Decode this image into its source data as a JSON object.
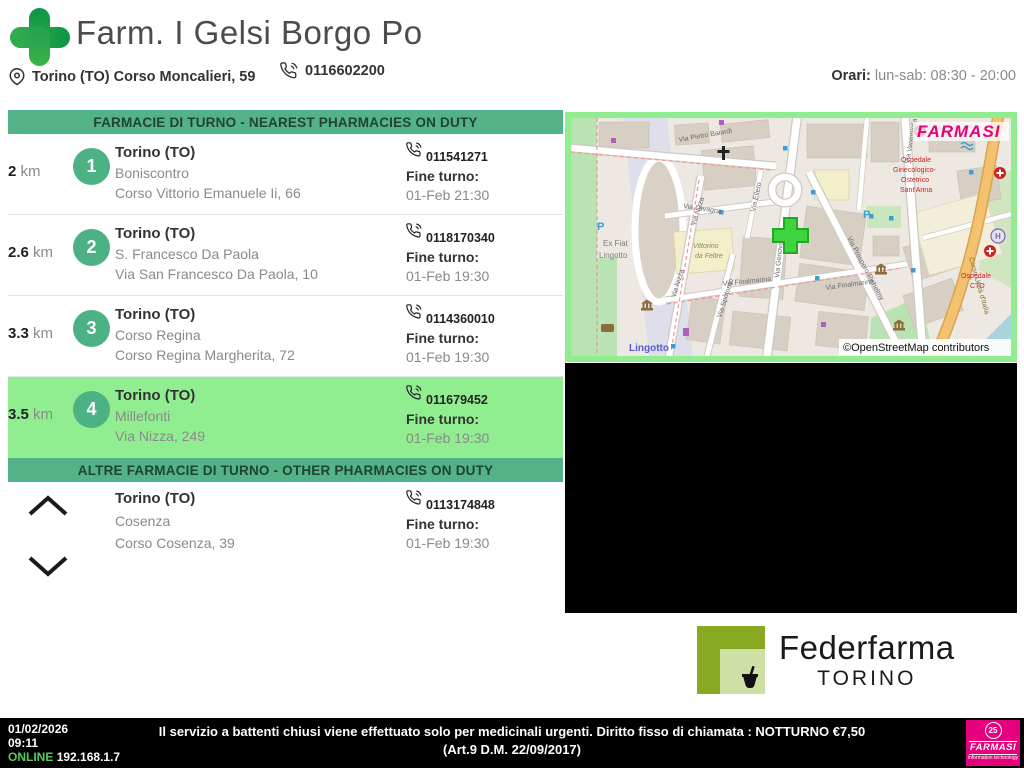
{
  "header": {
    "title": "Farm. I Gelsi Borgo Po",
    "address": "Torino (TO) Corso Moncalieri, 59",
    "phone": "0116602200",
    "orari_label": "Orari:",
    "orari_value": "lun-sab: 08:30 - 20:00"
  },
  "list": {
    "nearest_header": "FARMACIE DI TURNO - NEAREST PHARMACIES ON DUTY",
    "other_header": "ALTRE FARMACIE DI TURNO - OTHER PHARMACIES ON DUTY",
    "km_label": "km",
    "fine_turno_label": "Fine turno:",
    "rows": [
      {
        "distance": "2",
        "number": "1",
        "city": "Torino (TO)",
        "name": "Boniscontro",
        "address": "Corso Vittorio Emanuele Ii, 66",
        "phone": "011541271",
        "end": "01-Feb 21:30"
      },
      {
        "distance": "2.6",
        "number": "2",
        "city": "Torino (TO)",
        "name": "S. Francesco Da Paola",
        "address": "Via San Francesco Da Paola, 10",
        "phone": "0118170340",
        "end": "01-Feb 19:30"
      },
      {
        "distance": "3.3",
        "number": "3",
        "city": "Torino (TO)",
        "name": "Corso Regina",
        "address": "Corso Regina Margherita, 72",
        "phone": "0114360010",
        "end": "01-Feb 19:30"
      },
      {
        "distance": "3.5",
        "number": "4",
        "city": "Torino (TO)",
        "name": "Millefonti",
        "address": "Via Nizza, 249",
        "phone": "011679452",
        "end": "01-Feb 19:30"
      }
    ],
    "other_row": {
      "city": "Torino (TO)",
      "name": "Cosenza",
      "address": "Corso Cosenza, 39",
      "phone": "0113174848",
      "end": "01-Feb 19:30"
    }
  },
  "map": {
    "provider_logo": "FARMASI",
    "attribution": "©OpenStreetMap contributors",
    "labels": [
      {
        "t": "Via Pietro Baiardi",
        "x": 108,
        "y": 24,
        "s": 7,
        "c": "#6b6b6b",
        "r": -10
      },
      {
        "t": "Via Lavagna",
        "x": 112,
        "y": 90,
        "s": 7,
        "c": "#6b6b6b",
        "r": 8
      },
      {
        "t": "Via Ellero",
        "x": 184,
        "y": 94,
        "s": 7,
        "c": "#6b6b6b",
        "r": -78
      },
      {
        "t": "Via Genova",
        "x": 208,
        "y": 160,
        "s": 7,
        "c": "#6b6b6b",
        "r": -84
      },
      {
        "t": "Via Nizza",
        "x": 124,
        "y": 108,
        "s": 7,
        "c": "#6b6b6b",
        "r": -72
      },
      {
        "t": "Via Nizza",
        "x": 104,
        "y": 180,
        "s": 7,
        "c": "#6b6b6b",
        "r": -72
      },
      {
        "t": "Via Spotorno",
        "x": 150,
        "y": 200,
        "s": 7,
        "c": "#6b6b6b",
        "r": -72
      },
      {
        "t": "Via Finalmarina",
        "x": 152,
        "y": 168,
        "s": 7,
        "c": "#6b6b6b",
        "r": -6
      },
      {
        "t": "Via Finalmarina",
        "x": 255,
        "y": 172,
        "s": 7,
        "c": "#6b6b6b",
        "r": -8
      },
      {
        "t": "Via Prospero Richelmy",
        "x": 276,
        "y": 120,
        "s": 7,
        "c": "#6b6b6b",
        "r": 62
      },
      {
        "t": "Via Ventimiglia",
        "x": 338,
        "y": 46,
        "s": 7,
        "c": "#6b6b6b",
        "r": -80
      },
      {
        "t": "Vittorino",
        "x": 122,
        "y": 130,
        "s": 7,
        "c": "#8a8a5a",
        "r": 0,
        "i": 1
      },
      {
        "t": "da Feltre",
        "x": 124,
        "y": 140,
        "s": 7,
        "c": "#8a8a5a",
        "r": 0,
        "i": 1
      },
      {
        "t": "Ex Fiat",
        "x": 32,
        "y": 128,
        "s": 8,
        "c": "#7d7d7d",
        "r": 0
      },
      {
        "t": "Lingotto",
        "x": 28,
        "y": 140,
        "s": 8,
        "c": "#7d7d7d",
        "r": 0
      },
      {
        "t": "Lingotto",
        "x": 58,
        "y": 233,
        "s": 10,
        "c": "#5a5ad2",
        "r": 0,
        "b": 1
      },
      {
        "t": "Ospedale",
        "x": 330,
        "y": 44,
        "s": 7,
        "c": "#cc2222",
        "r": 0
      },
      {
        "t": "Ginecologico-",
        "x": 322,
        "y": 54,
        "s": 7,
        "c": "#cc2222",
        "r": 0
      },
      {
        "t": "Ostetrico",
        "x": 330,
        "y": 64,
        "s": 7,
        "c": "#cc2222",
        "r": 0
      },
      {
        "t": "Sant'Anna",
        "x": 329,
        "y": 74,
        "s": 7,
        "c": "#cc2222",
        "r": 0
      },
      {
        "t": "Ospedale",
        "x": 390,
        "y": 160,
        "s": 7,
        "c": "#cc2222",
        "r": 0
      },
      {
        "t": "CTO",
        "x": 399,
        "y": 170,
        "s": 7,
        "c": "#cc2222",
        "r": 0
      },
      {
        "t": "Corso Unità d'Italia",
        "x": 398,
        "y": 140,
        "s": 7,
        "c": "#8a6d3b",
        "r": 74
      },
      {
        "t": "P",
        "x": 26,
        "y": 112,
        "s": 11,
        "c": "#3b9fd4",
        "r": 0,
        "b": 1
      },
      {
        "t": "P",
        "x": 292,
        "y": 100,
        "s": 11,
        "c": "#3b9fd4",
        "r": 0,
        "b": 1
      },
      {
        "t": "H",
        "x": 424,
        "y": 121,
        "s": 8,
        "c": "#7b68ae",
        "r": 0,
        "b": 1
      }
    ]
  },
  "federfarma": {
    "line1": "Federfarma",
    "line2": "TORINO"
  },
  "footer": {
    "date": "01/02/2026",
    "time": "09:11",
    "status": "ONLINE",
    "ip": "192.168.1.7",
    "message": "Il servizio a battenti chiusi viene effettuato solo per medicinali urgenti. Diritto fisso di chiamata : NOTTURNO €7,50 (Art.9 D.M. 22/09/2017)",
    "logo_badge": "25",
    "logo_text": "FARMASI",
    "logo_sub": "information technology"
  },
  "colors": {
    "header_bar_green": "#53b287",
    "highlight_green": "#90ee90",
    "circle_green": "#4cb183",
    "brand_magenta": "#e6007d",
    "federfarma_green": "#87a922",
    "online_green": "#5cc85c",
    "logo_dark_green": "#0d9448",
    "logo_light_green": "#3cb44a"
  }
}
